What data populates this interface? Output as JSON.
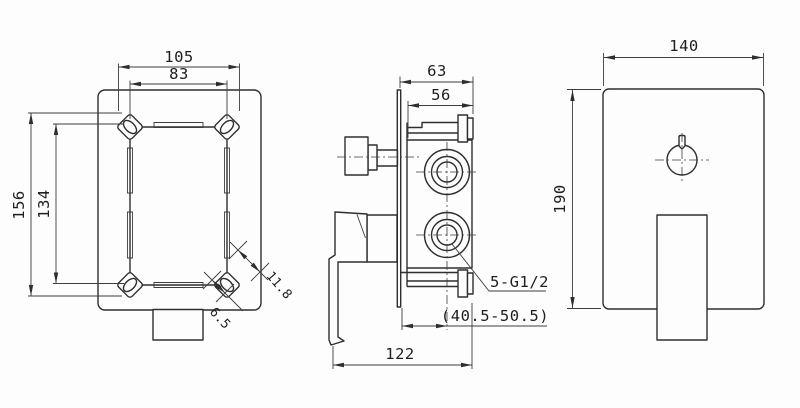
{
  "drawing": {
    "front_view": {
      "width_outer": "105",
      "width_inner": "83",
      "height_outer": "156",
      "height_inner": "134",
      "corner_tab": "11.8",
      "tab_slot": "6.5"
    },
    "side_view": {
      "depth_outer": "63",
      "depth_body": "56",
      "thread": "5-G1/2",
      "wall_range": "(40.5-50.5)",
      "length_total": "122"
    },
    "rear_view": {
      "plate_width": "140",
      "plate_height": "190"
    }
  }
}
